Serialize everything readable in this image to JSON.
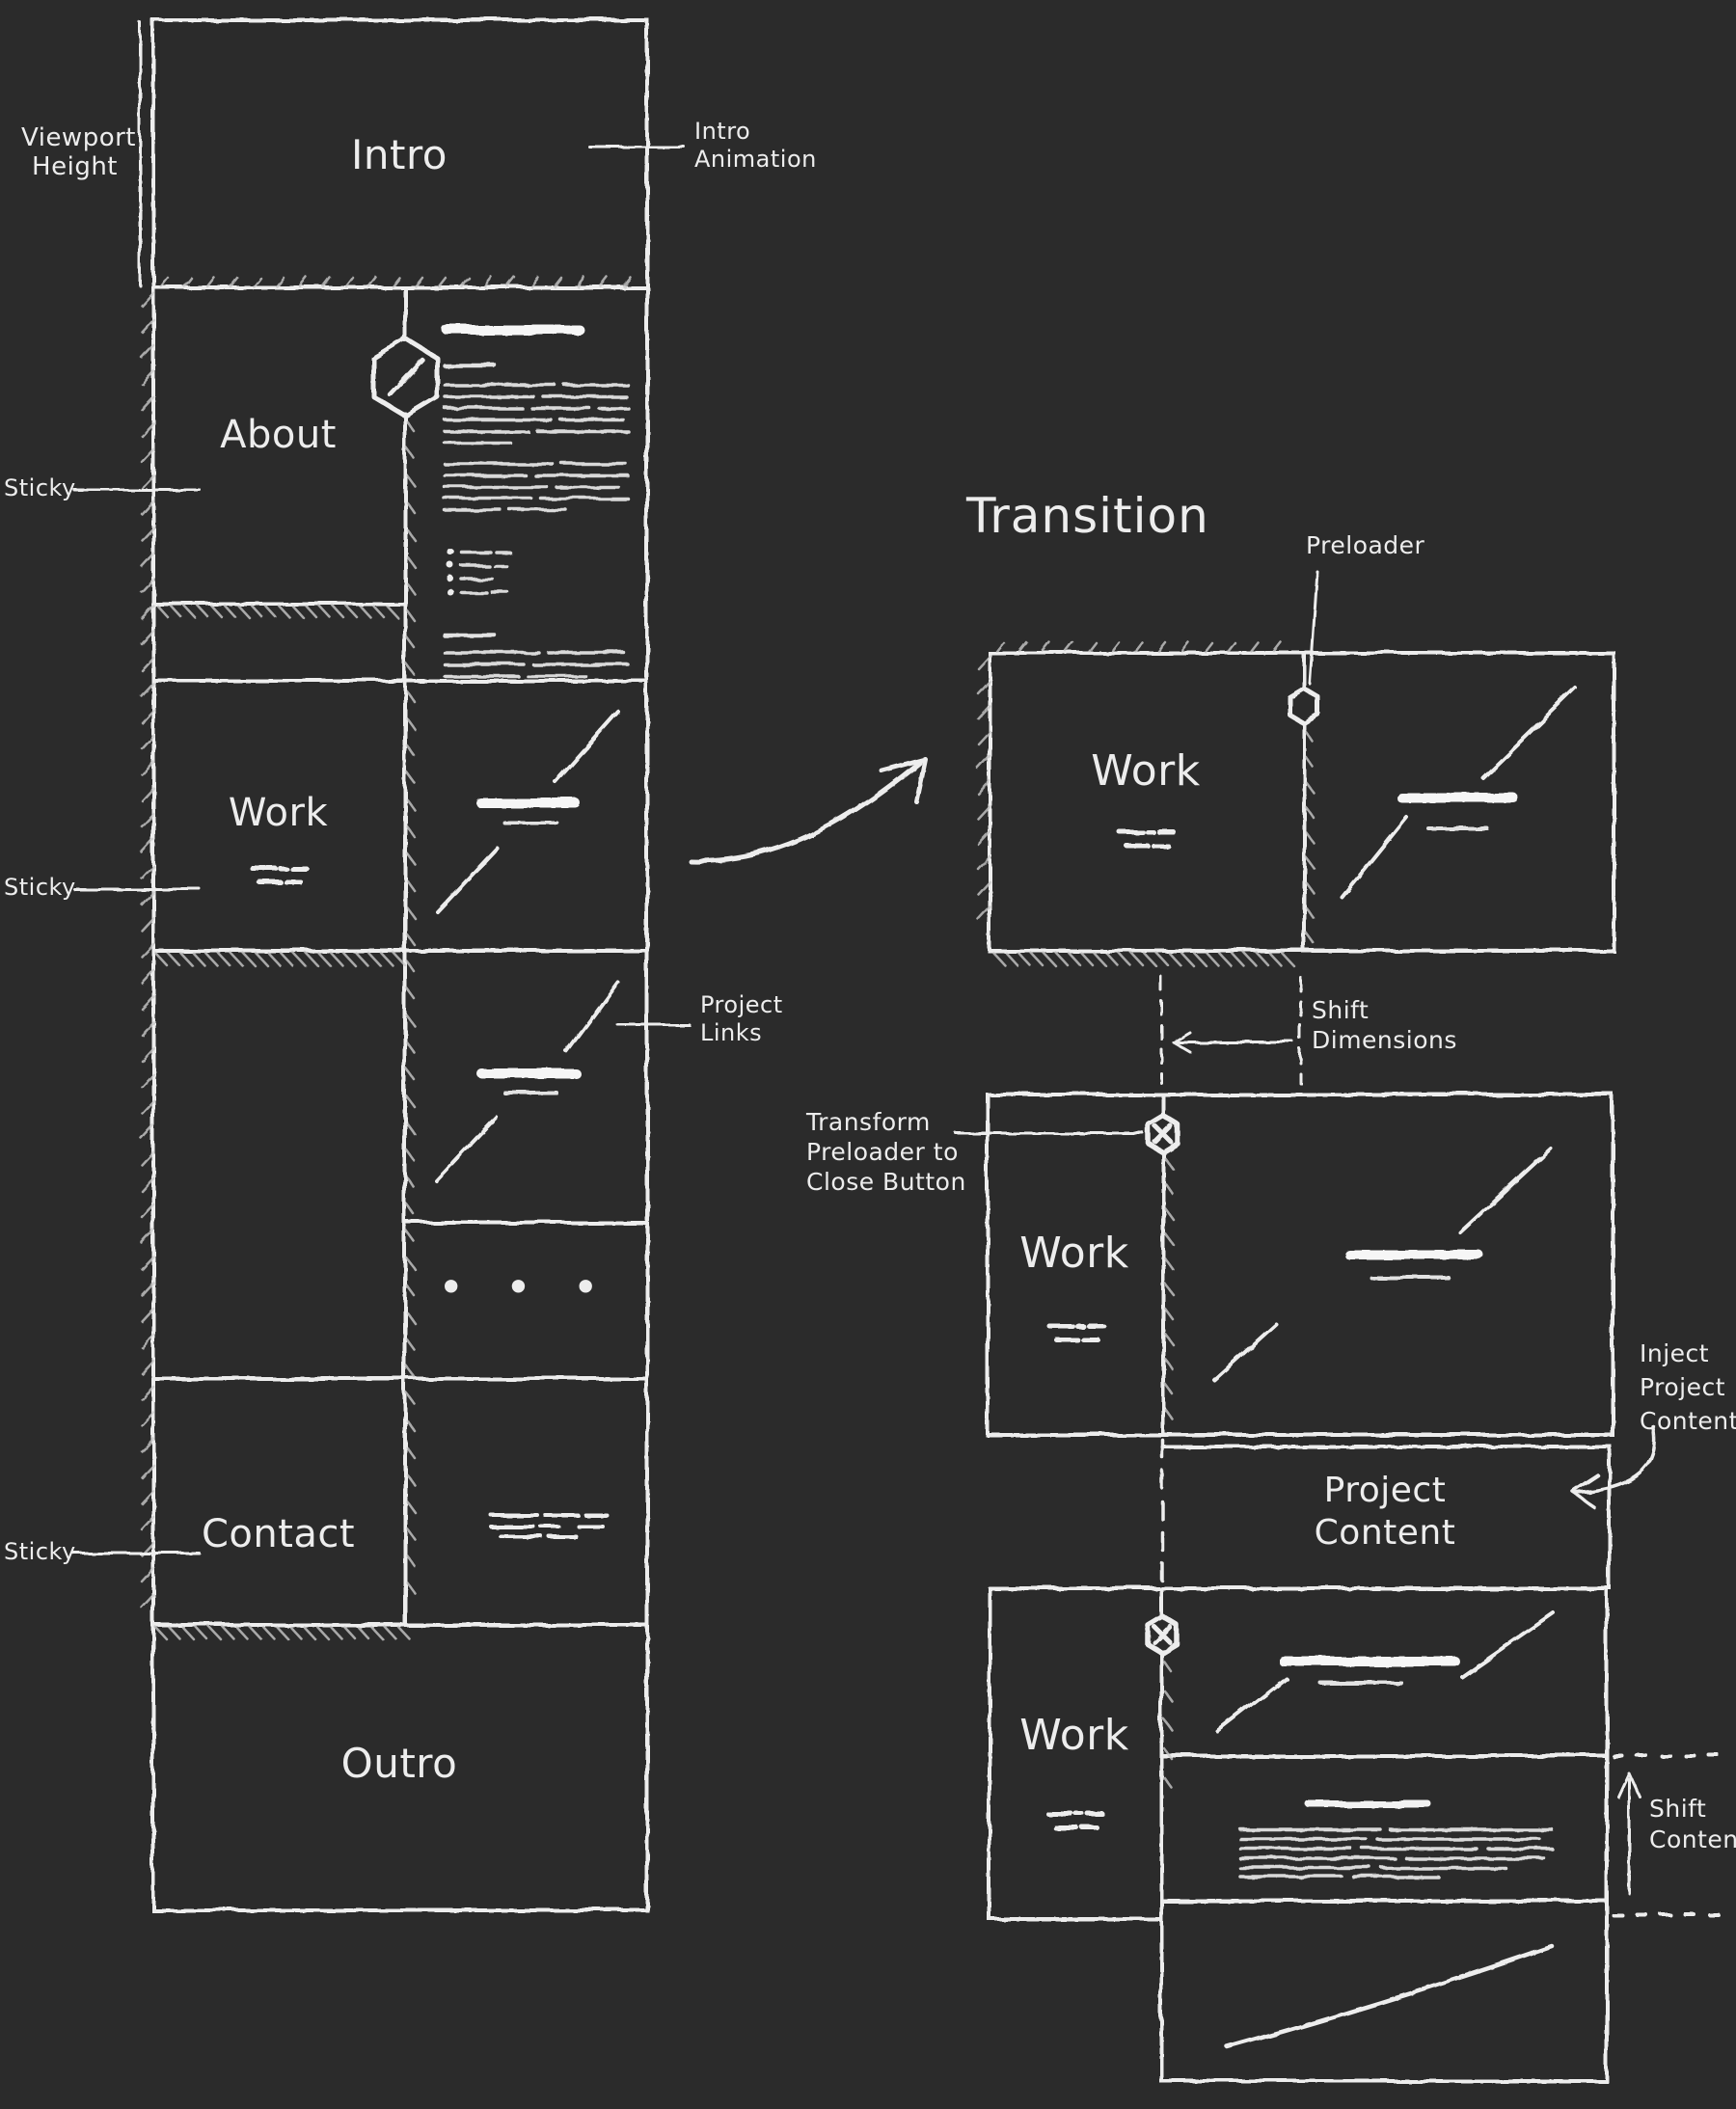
{
  "colors": {
    "background": "#2b2b2b",
    "ink": "#ededed"
  },
  "sitemap": {
    "viewport_height": [
      "Viewport",
      "Height"
    ],
    "intro": "Intro",
    "intro_animation": [
      "Intro",
      "Animation"
    ],
    "about": "About",
    "sticky": "Sticky",
    "work": "Work",
    "project_links": [
      "Project",
      "Links"
    ],
    "more_dots": "• • •",
    "contact": "Contact",
    "outro": "Outro"
  },
  "transition": {
    "heading": "Transition",
    "preloader": "Preloader",
    "work": "Work",
    "shift_dimensions": [
      "Shift",
      "Dimensions"
    ],
    "transform_preloader": [
      "Transform",
      "Preloader to",
      "Close Button"
    ],
    "inject_project_content": [
      "Inject",
      "Project",
      "Content"
    ],
    "project_content": [
      "Project",
      "Content"
    ],
    "shift_content": [
      "Shift",
      "Content"
    ]
  }
}
